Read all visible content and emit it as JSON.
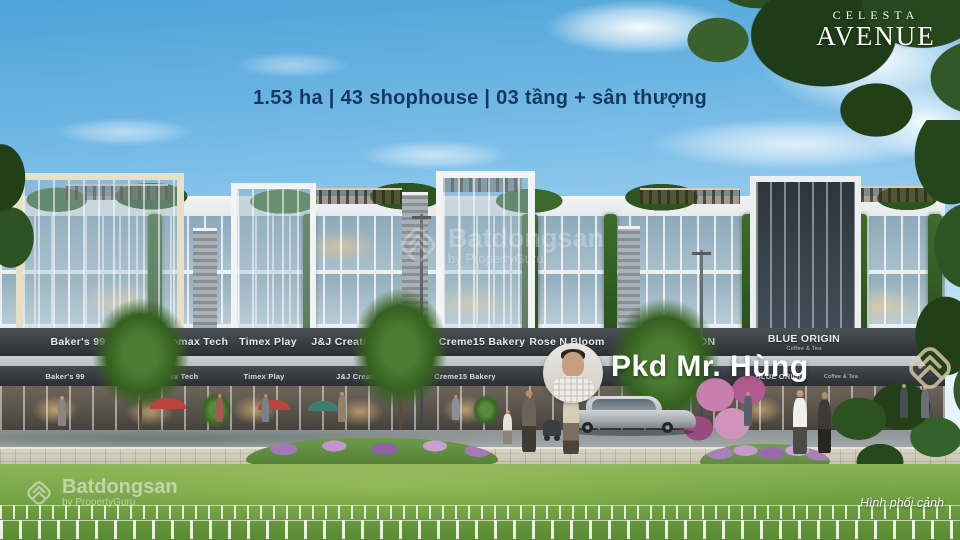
{
  "headline": "1.53 ha | 43 shophouse | 03 tầng + sân thượng",
  "logo": {
    "line1": "CELESTA",
    "line2": "AVENUE"
  },
  "agent": {
    "name": "Pkd Mr. Hùng"
  },
  "caption": "Hình phối cảnh",
  "watermark": {
    "brand": "Batdongsan",
    "byline": "by PropertyGuru",
    "icon": "batdongsan-house-icon"
  },
  "signs": {
    "upper": [
      {
        "label": "Baker's 99"
      },
      {
        "label": "Promax Tech"
      },
      {
        "label": "Timex Play"
      },
      {
        "label": "J&J Creative"
      },
      {
        "label": "Creme15 Bakery"
      },
      {
        "label": "Rose N Bloom"
      },
      {
        "label": "FASHION"
      },
      {
        "label": "BLUE ORIGIN",
        "sub": "Coffee & Tea"
      }
    ],
    "lower": [
      {
        "label": "Baker's 99"
      },
      {
        "label": "Promax Tech"
      },
      {
        "label": "Timex Play"
      },
      {
        "label": "J&J Creative"
      },
      {
        "label": "Creme15 Bakery"
      },
      {
        "label": "BLUE ORIGIN",
        "sub": "Coffee & Tea"
      }
    ]
  },
  "colors": {
    "headline_text": "#17375f",
    "sky": "#7fc0e8",
    "sign_band": "#2c3035",
    "watermark_gold": "#dccfa9"
  }
}
